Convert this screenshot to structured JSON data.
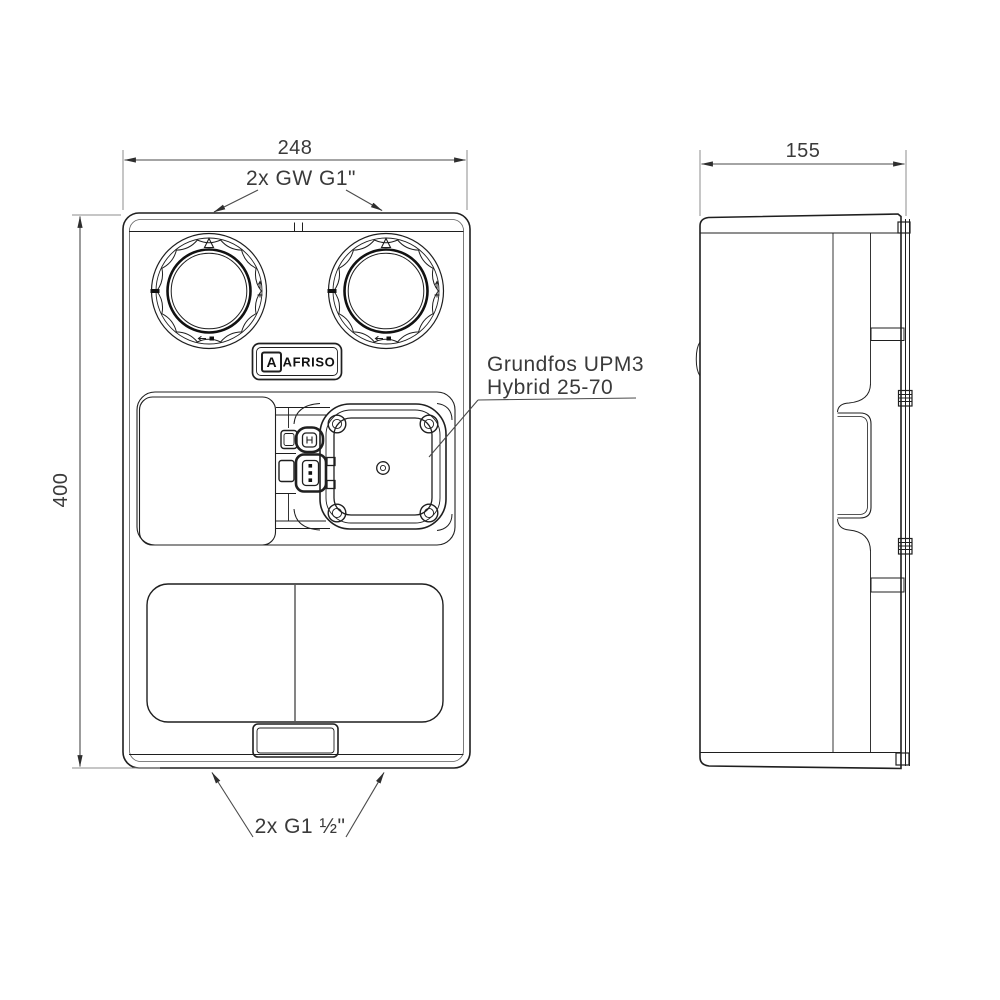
{
  "colors": {
    "background": "#ffffff",
    "line": "#1f1f1f",
    "dimension": "#3a3a3a",
    "extension": "#8d8d8d"
  },
  "dimensions": {
    "front_width": "248",
    "front_height": "400",
    "side_depth": "155"
  },
  "callouts": {
    "top_ports": "2x GW G1\"",
    "pump_label_line1": "Grundfos UPM3",
    "pump_label_line2": "Hybrid 25-70",
    "bottom_ports": "2x G1 ½\""
  },
  "branding": {
    "logo_letter": "A",
    "logo_text": "AFRISO"
  }
}
